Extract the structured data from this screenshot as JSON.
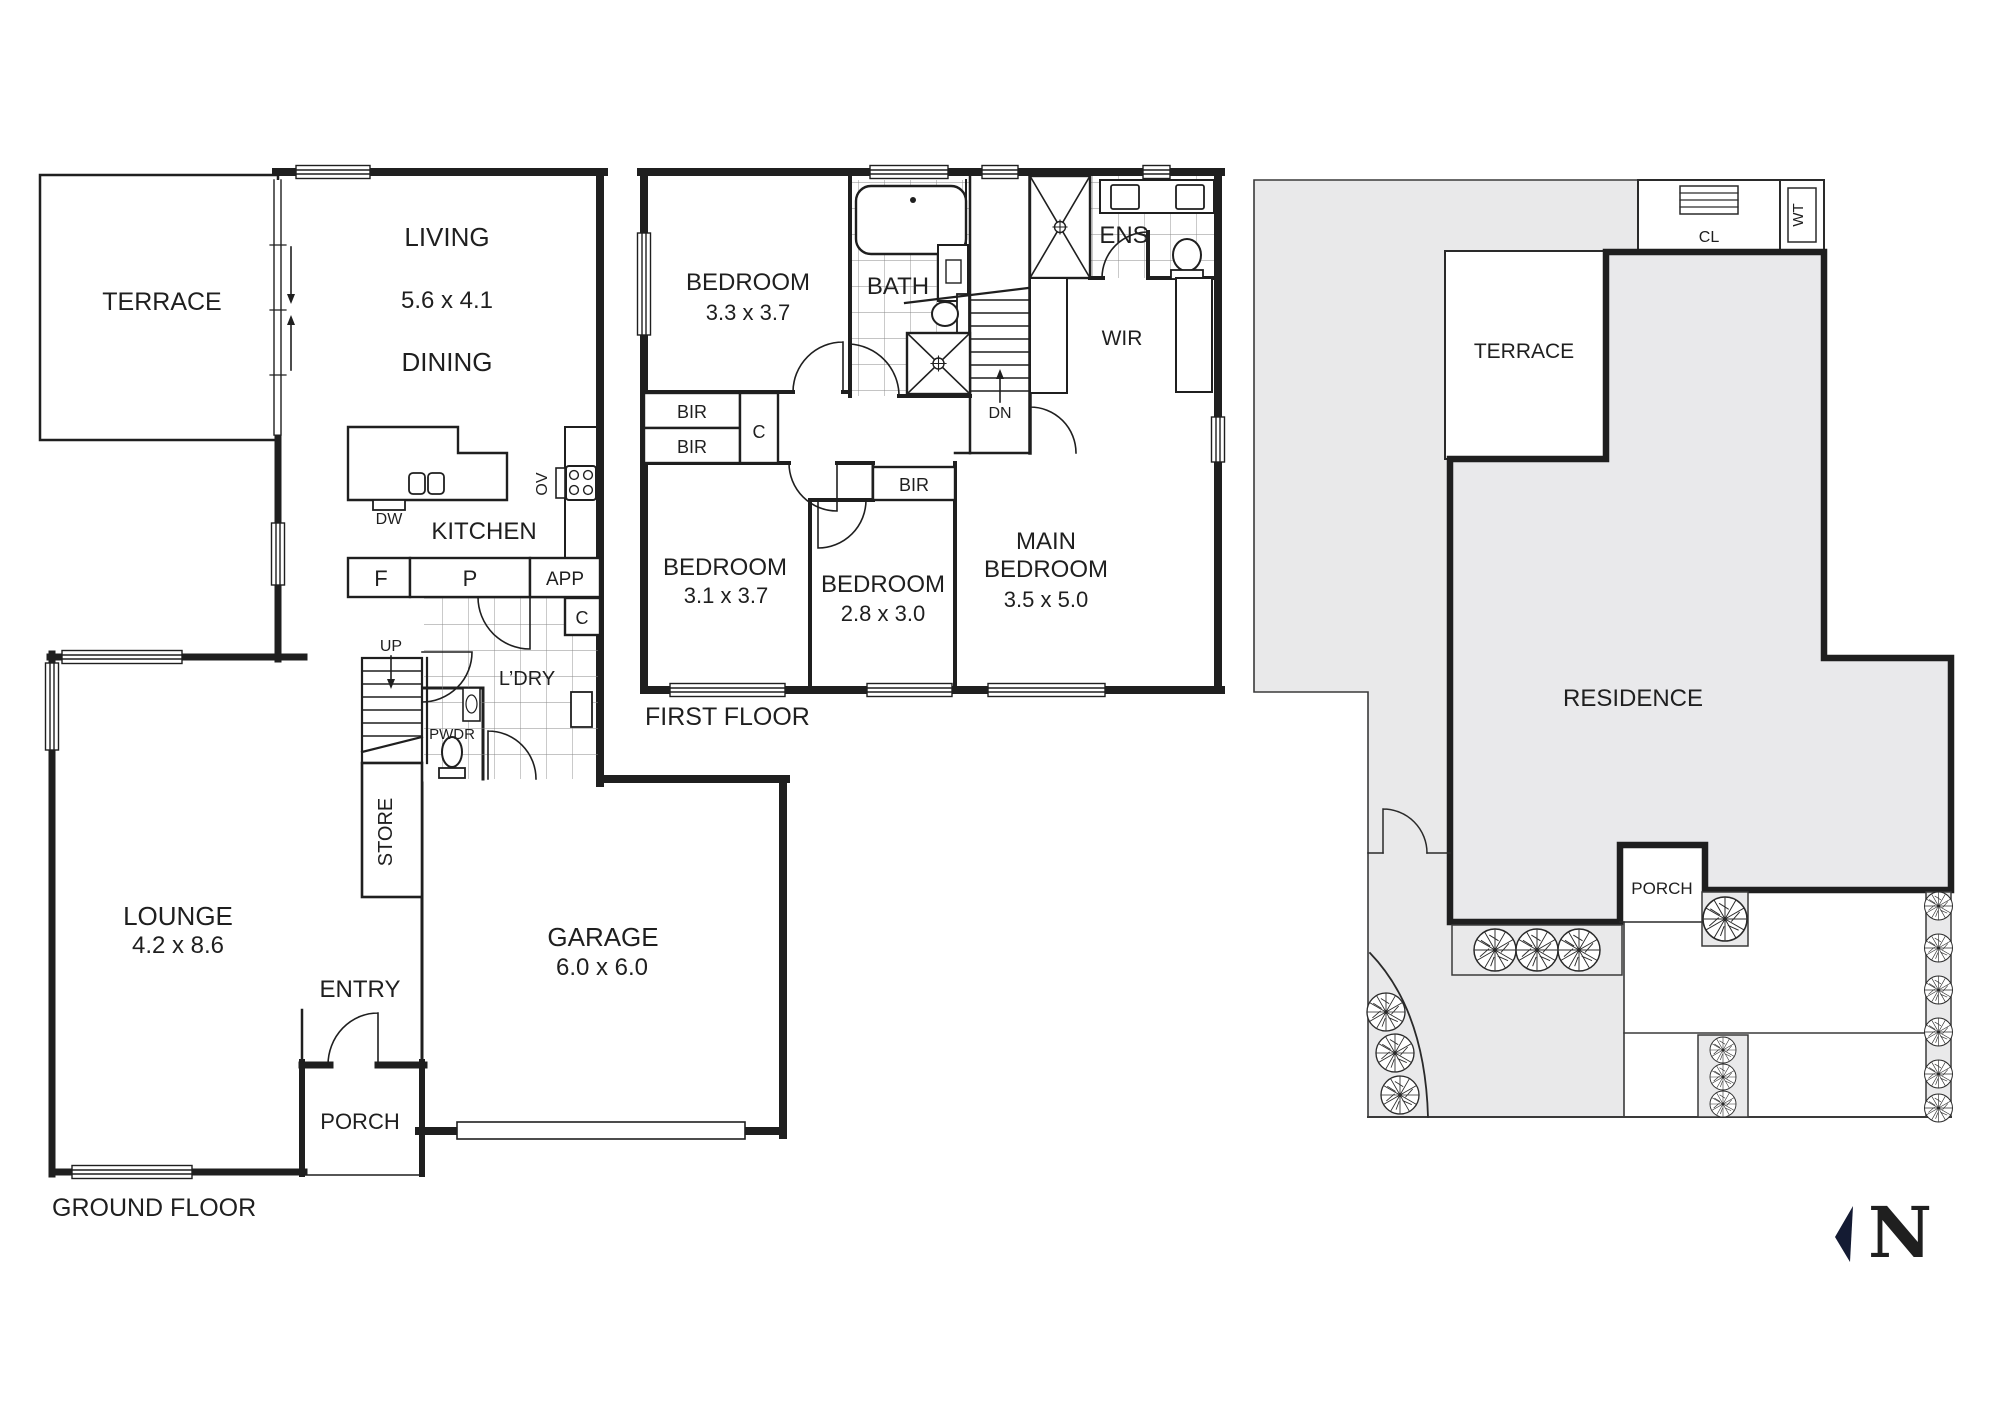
{
  "colors": {
    "line": "#1f1f1f",
    "site_fill": "#e9e9ea",
    "compass_navy": "#141b33",
    "paper": "#ffffff"
  },
  "ground_floor": {
    "title": "GROUND FLOOR",
    "terrace": "TERRACE",
    "living": "LIVING",
    "living_dim": "5.6 x 4.1",
    "dining": "DINING",
    "kitchen": "KITCHEN",
    "lounge": "LOUNGE",
    "lounge_dim": "4.2 x 8.6",
    "entry": "ENTRY",
    "porch": "PORCH",
    "garage": "GARAGE",
    "garage_dim": "6.0 x 6.0",
    "laundry": "L’DRY",
    "powder": "PWDR",
    "store": "STORE",
    "dishwasher": "DW",
    "oven": "OV",
    "fridge": "F",
    "pantry": "P",
    "appliances": "APP",
    "cupboard": "C",
    "stairs_up": "UP"
  },
  "first_floor": {
    "title": "FIRST FLOOR",
    "bedroom1": "BEDROOM",
    "bedroom1_dim": "3.3 x 3.7",
    "bath": "BATH",
    "ensuite": "ENS",
    "wardrobe": "WIR",
    "bedroom2": "BEDROOM",
    "bedroom2_dim": "3.1 x 3.7",
    "bedroom3": "BEDROOM",
    "bedroom3_dim": "2.8 x 3.0",
    "main_bedroom_line1": "MAIN",
    "main_bedroom_line2": "BEDROOM",
    "main_bedroom_dim": "3.5 x 5.0",
    "built_in_robe": "BIR",
    "cupboard": "C",
    "stairs_down": "DN"
  },
  "site_plan": {
    "terrace": "TERRACE",
    "residence": "RESIDENCE",
    "porch": "PORCH",
    "clothesline": "CL",
    "water_tank": "WT"
  },
  "compass": {
    "north": "N"
  }
}
